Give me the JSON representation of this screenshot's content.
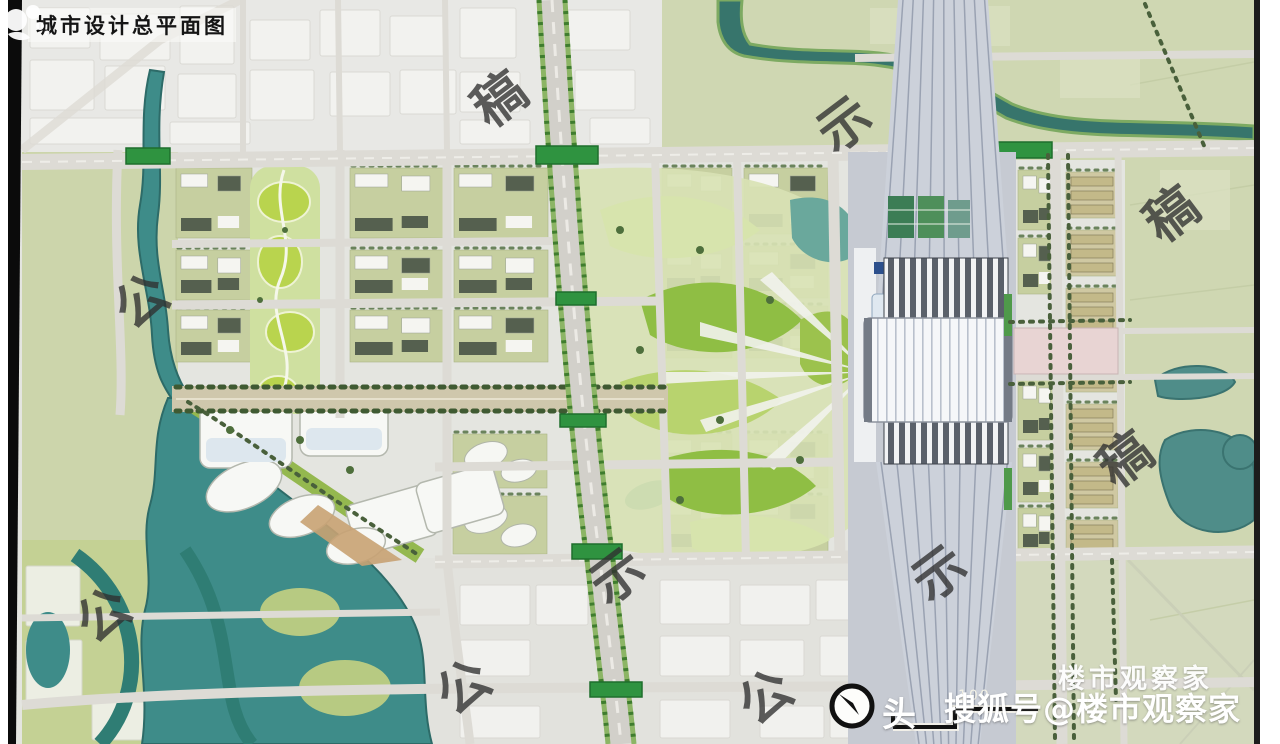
{
  "title": {
    "text": "城市设计总平面图"
  },
  "watermarks": {
    "stamps": [
      {
        "char": "稿",
        "x": 500,
        "y": 100
      },
      {
        "char": "示",
        "x": 845,
        "y": 125
      },
      {
        "char": "公",
        "x": 142,
        "y": 302
      },
      {
        "char": "稿",
        "x": 1172,
        "y": 215
      },
      {
        "char": "稿",
        "x": 1126,
        "y": 460
      },
      {
        "char": "示",
        "x": 618,
        "y": 577
      },
      {
        "char": "示",
        "x": 940,
        "y": 574
      },
      {
        "char": "公",
        "x": 104,
        "y": 616
      },
      {
        "char": "公",
        "x": 464,
        "y": 688
      },
      {
        "char": "公",
        "x": 766,
        "y": 698
      }
    ],
    "brand_line": "楼市观察家",
    "account_line": "搜狐号@楼市观察家",
    "partial_char": "头"
  },
  "scale_bar": {
    "label": "100"
  },
  "icons": {
    "north_arrow": "north-arrow-compass",
    "logo": "mascot-logo"
  },
  "palette": {
    "water": "#3e8c89",
    "water_edge": "#2d6b68",
    "park_bright": "#8fbe44",
    "park_mid": "#b8d36e",
    "park_pale": "#d7e4ad",
    "rural_green": "#cfd7b2",
    "urban_gray": "#e8e8e5",
    "road_gray": "#dddbd5",
    "rail_gray": "#c6cad2",
    "station_white": "#f5f7f9",
    "plaza_pink": "#e8d4d3",
    "bridge_green": "#2f9340",
    "stamp_gray": "#303030"
  }
}
